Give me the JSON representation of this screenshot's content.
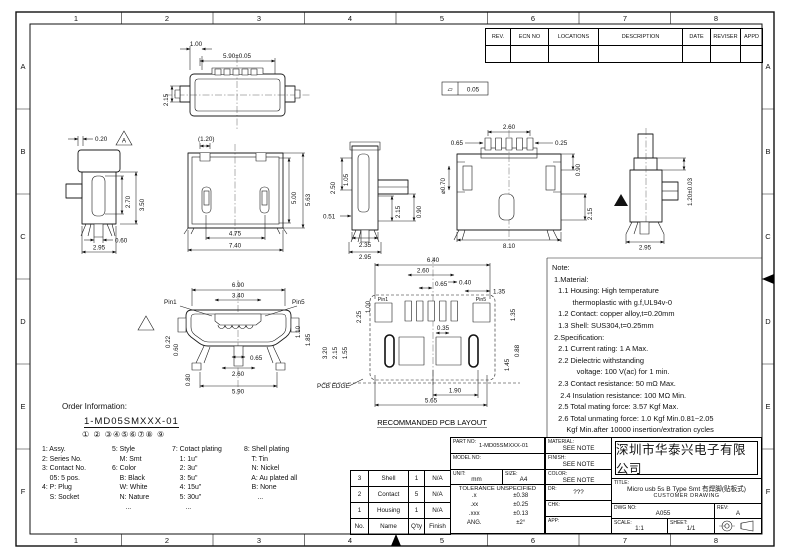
{
  "sheet": {
    "zones_h": [
      "1",
      "2",
      "3",
      "4",
      "5",
      "6",
      "7",
      "8"
    ],
    "zones_v": [
      "A",
      "B",
      "C",
      "D",
      "E",
      "F"
    ]
  },
  "revision_table": {
    "headers": [
      "REV.",
      "ECN NO",
      "LOCATIONS",
      "DESCRIPTION",
      "DATE",
      "REVISER",
      "APPD"
    ]
  },
  "views": {
    "top": {
      "dims": [
        "1.00",
        "5.90±0.05",
        "2.15"
      ],
      "flatness_symbol": "▱",
      "flatness": "0.05"
    },
    "side_a": {
      "datum": "A",
      "dims": [
        "0.20",
        "2.70",
        "3.50",
        "0.60",
        "2.95"
      ]
    },
    "front": {
      "dims": [
        "(1.20)",
        "5.00",
        "5.63",
        "4.75",
        "7.40"
      ]
    },
    "side_b": {
      "dims": [
        "2.50",
        "1.05",
        "0.51",
        "2.15",
        "0.90",
        "2.35",
        "2.95"
      ]
    },
    "back": {
      "dims": [
        "2.60",
        "0.65",
        "0.25",
        "⌀0.70",
        "0.90",
        "2.15",
        "8.10"
      ]
    },
    "side_c": {
      "dims": [
        "1.20±0.03",
        "2.95"
      ]
    },
    "bottom": {
      "pins": [
        "Pin1",
        "Pin5"
      ],
      "dims": [
        "6.90",
        "3.40",
        "0.22",
        "0.60",
        "0.80",
        "1.10",
        "1.85",
        "0.65",
        "2.60",
        "5.90"
      ]
    },
    "pcb": {
      "pins": [
        "Pin1",
        "Pin5"
      ],
      "dims": [
        "6.40",
        "2.60",
        "0.65",
        "0.40",
        "1.35",
        "2.25",
        "1.00",
        "3.20",
        "2.15",
        "1.55",
        "0.35",
        "1.35",
        "0.88",
        "1.45",
        "1.90",
        "5.65"
      ],
      "pcb_edge": "PCB EDGE",
      "caption": "RECOMMANDED PCB LAYOUT"
    }
  },
  "notes": {
    "lines": [
      "Note:",
      " 1.Material:",
      "   1.1 Housing: High temperature",
      "          thermoplastic with g.f,UL94v-0",
      "   1.2 Contact: copper alloy,t=0.20mm",
      "   1.3 Shell: SUS304,t=0.25mm",
      " 2.Specification:",
      "   2.1 Current rating: 1 A Max.",
      "   2.2 Dielectric withstanding",
      "            voltage: 100 V(ac) for 1 min.",
      "   2.3 Contact resistance: 50 mΩ Max.",
      "    2.4 Insulation resistance: 100 MΩ Min.",
      "   2.5 Total mating force: 3.57 Kgf Max.",
      "   2.6 Total unmating force: 1.0 Kgf Min.0.81~2.05",
      "       Kgf Min.after 10000 insertion/extration cycles",
      "   2.7 Temperature range: -30°C~80°C"
    ]
  },
  "order_info": {
    "heading": "Order Information:",
    "part_number": "1-MD05SMXXX-01",
    "digits": "①    ②    ③④⑤⑥⑦⑧    ⑨",
    "columns": [
      [
        "1: Assy.",
        "2: Series No.",
        "3: Contact No.",
        "    05: 5 pos.",
        "4: P: Plug",
        "    S: Socket"
      ],
      [
        "5: Style",
        "    M: Smt",
        "6: Color",
        "    B: Black",
        "    W: White",
        "    N: Nature",
        "       ..."
      ],
      [
        "7: Cotact plating",
        "    1: 1u\"",
        "    2: 3u\"",
        "    3: 5u\"",
        "    4: 15u\"",
        "    5: 30u\"",
        "       ..."
      ],
      [
        "8: Shell plating",
        "    T: Tin",
        "    N: Nickel",
        "    A: Au plated all",
        "    B: None",
        "       ..."
      ]
    ]
  },
  "parts_table": {
    "rows": [
      [
        "3",
        "Shell",
        "1",
        "N/A"
      ],
      [
        "2",
        "Contact",
        "5",
        "N/A"
      ],
      [
        "1",
        "Housing",
        "1",
        "N/A"
      ]
    ],
    "header": [
      "No.",
      "Name",
      "Q'ty",
      "Finish"
    ]
  },
  "title_block": {
    "part_no_label": "PART NO:",
    "part_no": "1-MD05SMXXX-01",
    "model_no_label": "MODEL NO:",
    "model_no": "",
    "unit_label": "UNIT:",
    "unit": "mm",
    "size_label": "SIZE:",
    "size": "A4",
    "tolerance_title": "TOLERANCE UNSPECIFIED",
    "tolerance_rows": [
      [
        ".x",
        "±0.38"
      ],
      [
        ".xx",
        "±0.25"
      ],
      [
        ".xxx",
        "±0.13"
      ],
      [
        "ANG.",
        "±2°"
      ]
    ],
    "material_label": "MATERIAL:",
    "material": "SEE NOTE",
    "finish_label": "FINISH:",
    "finish": "SEE NOTE",
    "color_label": "COLOR:",
    "color": "SEE NOTE",
    "dr_label": "DR:",
    "dr": "???",
    "chk_label": "CHK:",
    "chk": "",
    "app_label": "APP:",
    "app": "",
    "company": "深圳市华泰兴电子有限公司",
    "title_label": "TITLE:",
    "title": "Micro usb 5s B Type Smt 有焊脚(贴板式)",
    "subtitle": "CUSTOMER DRAWING",
    "dwg_label": "DWG NO:",
    "dwg_no": "A055",
    "rev_label": "REV:",
    "rev": "A",
    "scale_label": "SCALE:",
    "scale": "1:1",
    "sheet_label": "SHEET:",
    "sheet": "1/1"
  }
}
